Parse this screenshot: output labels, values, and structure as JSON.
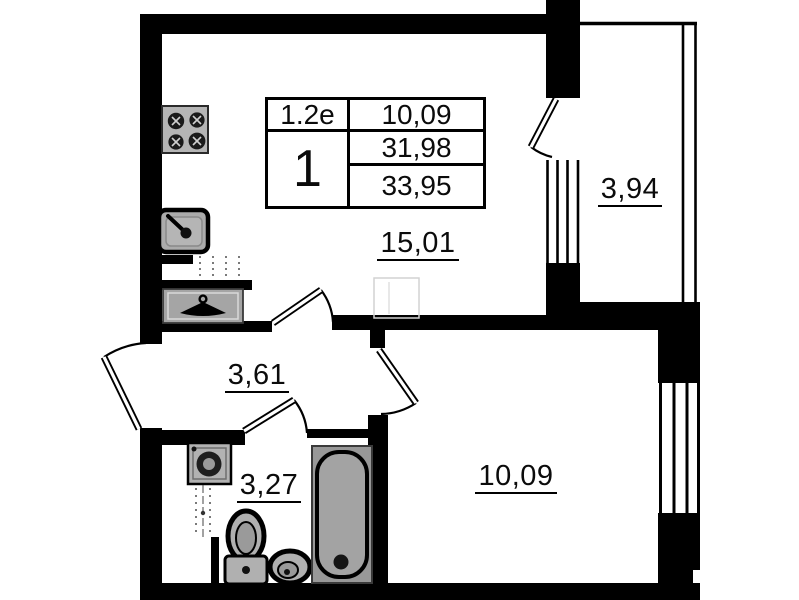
{
  "plan": {
    "title": "one-room apartment floor plan",
    "info_table": {
      "unit_type": "1.2e",
      "rooms_count": "1",
      "row1_area": "10,09",
      "row2_area": "31,98",
      "row3_area": "33,95"
    },
    "areas": {
      "living_kitchen": "15,01",
      "balcony": "3,94",
      "hallway": "3,61",
      "bathroom": "3,27",
      "bedroom": "10,09"
    },
    "fixtures": [
      "stove-icon",
      "kitchen-sink-icon",
      "wardrobe-hanger-icon",
      "washing-machine-icon",
      "toilet-icon",
      "pedestal-sink-icon",
      "bathtub-icon"
    ],
    "colors": {
      "wall": "#000000",
      "fixture_gray": "#ababab",
      "fixture_dark": "#1e1e1e",
      "background": "#ffffff"
    }
  }
}
